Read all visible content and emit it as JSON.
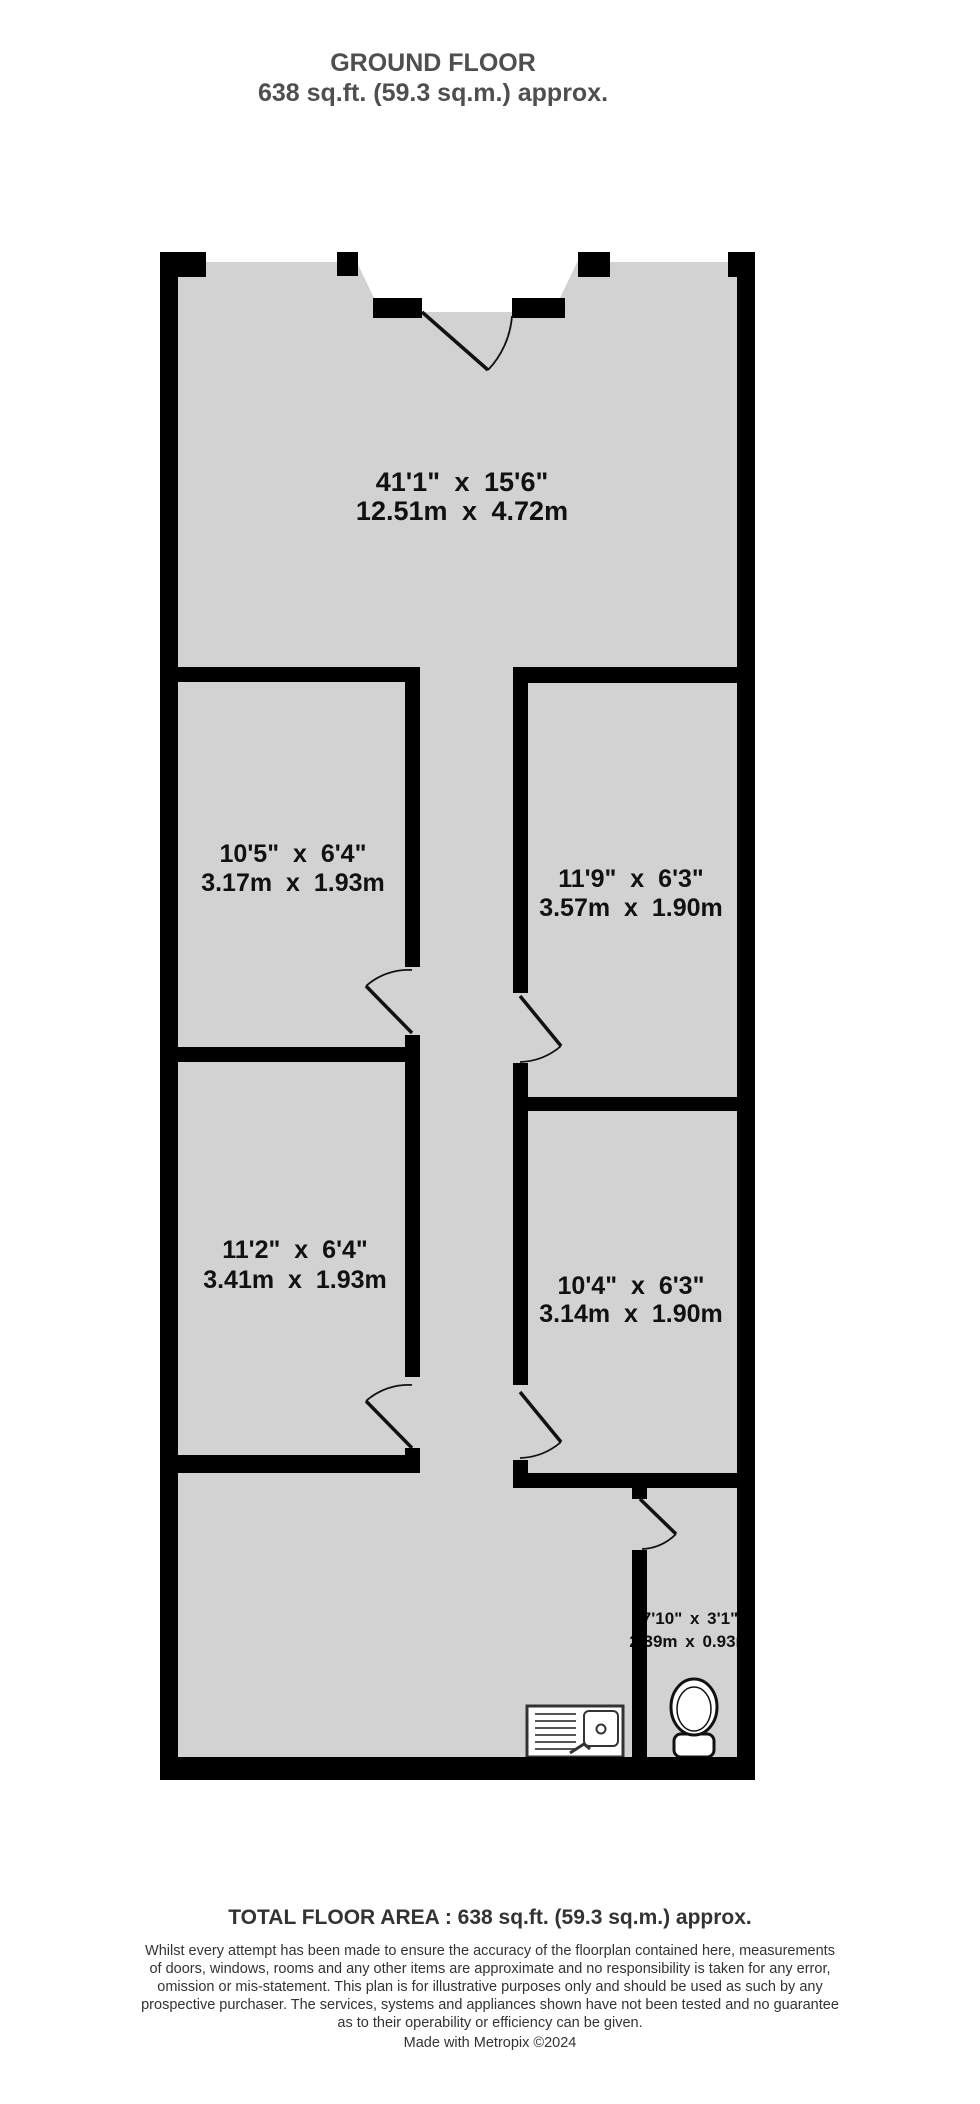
{
  "title": {
    "line1": "GROUND FLOOR",
    "line2": "638 sq.ft. (59.3 sq.m.) approx."
  },
  "rooms": [
    {
      "id": "main-room",
      "imperial": "41'1\"  x 15'6\"",
      "metric": "12.51m  x 4.72m"
    },
    {
      "id": "left-room-1",
      "imperial": "10'5\"  x 6'4\"",
      "metric": "3.17m  x 1.93m"
    },
    {
      "id": "right-room-1",
      "imperial": "11'9\"  x 6'3\"",
      "metric": "3.57m  x 1.90m"
    },
    {
      "id": "left-room-2",
      "imperial": "11'2\"  x 6'4\"",
      "metric": "3.41m  x 1.93m"
    },
    {
      "id": "right-room-2",
      "imperial": "10'4\"  x 6'3\"",
      "metric": "3.14m  x 1.90m"
    },
    {
      "id": "wc",
      "imperial": "7'10\"  x 3'1\"",
      "metric": "2.39m  x 0.93m"
    }
  ],
  "footer": {
    "total_area": "TOTAL FLOOR AREA : 638 sq.ft. (59.3 sq.m.) approx.",
    "disclaimer_lines": [
      "Whilst every attempt has been made to ensure the accuracy of the floorplan contained here, measurements",
      "of doors, windows, rooms and any other items are approximate and no responsibility is taken for any error,",
      "omission or mis-statement. This plan is for illustrative purposes only and should be used as such by any",
      "prospective purchaser. The services, systems and appliances shown have not been tested and no guarantee",
      "as to their operability or efficiency can be given."
    ],
    "credit": "Made with Metropix ©2024"
  },
  "colors": {
    "wall": "#000000",
    "floor": "#d2d2d2",
    "label": "#111111",
    "title": "#4f4f4f"
  }
}
